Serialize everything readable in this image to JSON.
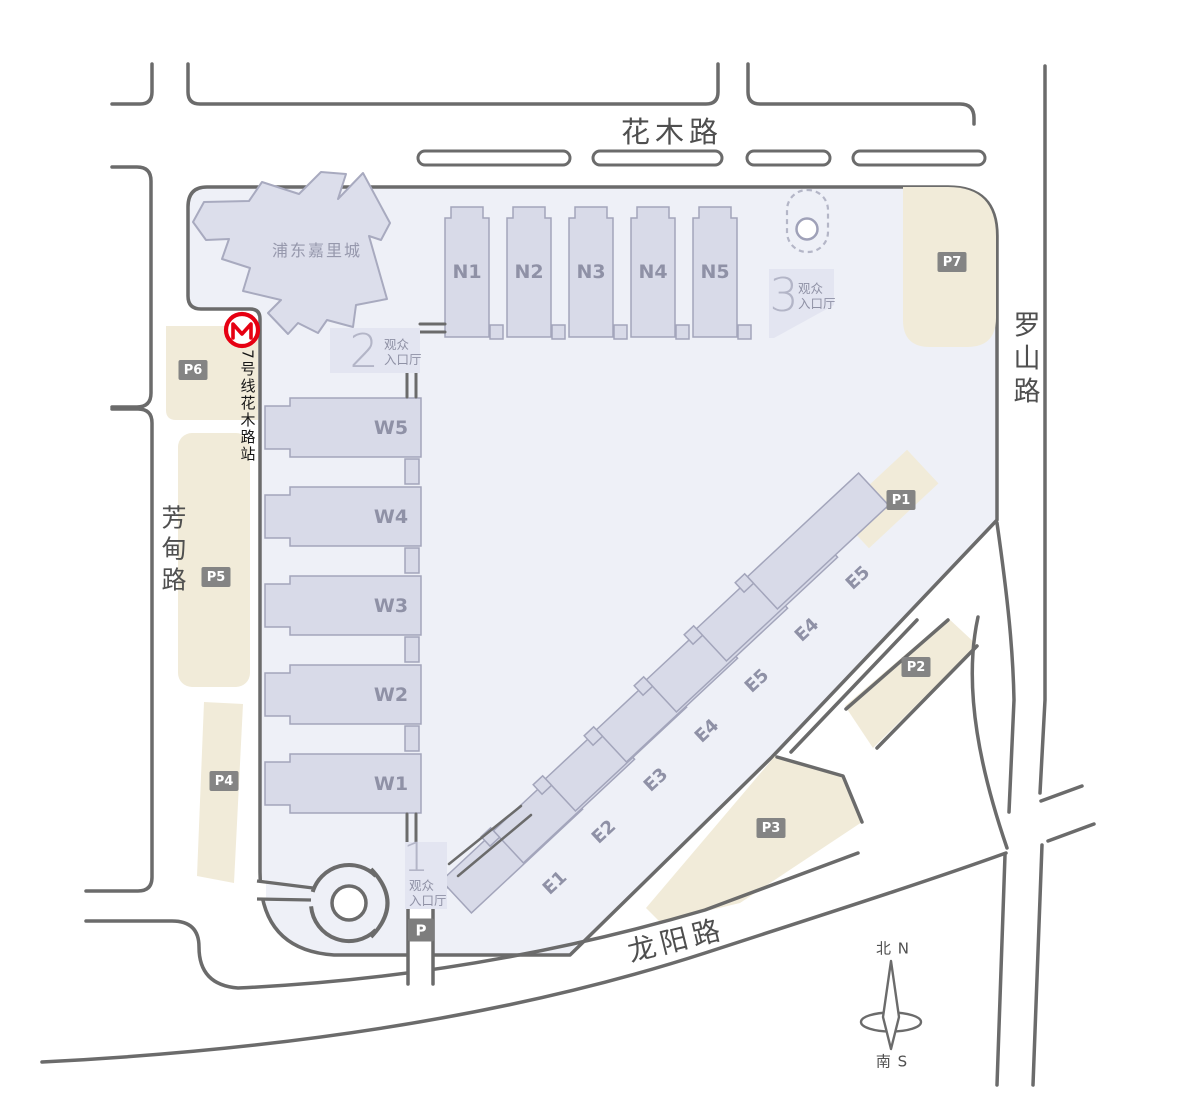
{
  "roads": {
    "huamu": "花木路",
    "luoshan": "罗山路",
    "fangdian": "芳甸路",
    "longyang": "龙阳路"
  },
  "landmarks": {
    "kerry": "浦东嘉里城",
    "metro_station": "7号线花木路站"
  },
  "halls": {
    "n": [
      "N1",
      "N2",
      "N3",
      "N4",
      "N5"
    ],
    "w": [
      "W5",
      "W4",
      "W3",
      "W2",
      "W1"
    ],
    "e": [
      "E1",
      "E2",
      "E3",
      "E4",
      "E5",
      "E4",
      "E5"
    ]
  },
  "entrances": {
    "e1": {
      "num": "1",
      "line1": "观众",
      "line2": "入口厅"
    },
    "e2": {
      "num": "2",
      "line1": "观众",
      "line2": "入口厅"
    },
    "e3": {
      "num": "3",
      "line1": "观众",
      "line2": "入口厅"
    }
  },
  "parking": {
    "badges": [
      "P1",
      "P2",
      "P3",
      "P4",
      "P5",
      "P6",
      "P7"
    ],
    "mini": "P"
  },
  "compass": {
    "north": "北 N",
    "south": "南 S"
  },
  "colors": {
    "metro_red": "#e60012",
    "parking_beige": "#f1ebd9",
    "hall_fill": "#d8dae8",
    "site_fill": "#eef0f7",
    "road_line": "#6b6b6b",
    "badge_bg": "#848484"
  }
}
